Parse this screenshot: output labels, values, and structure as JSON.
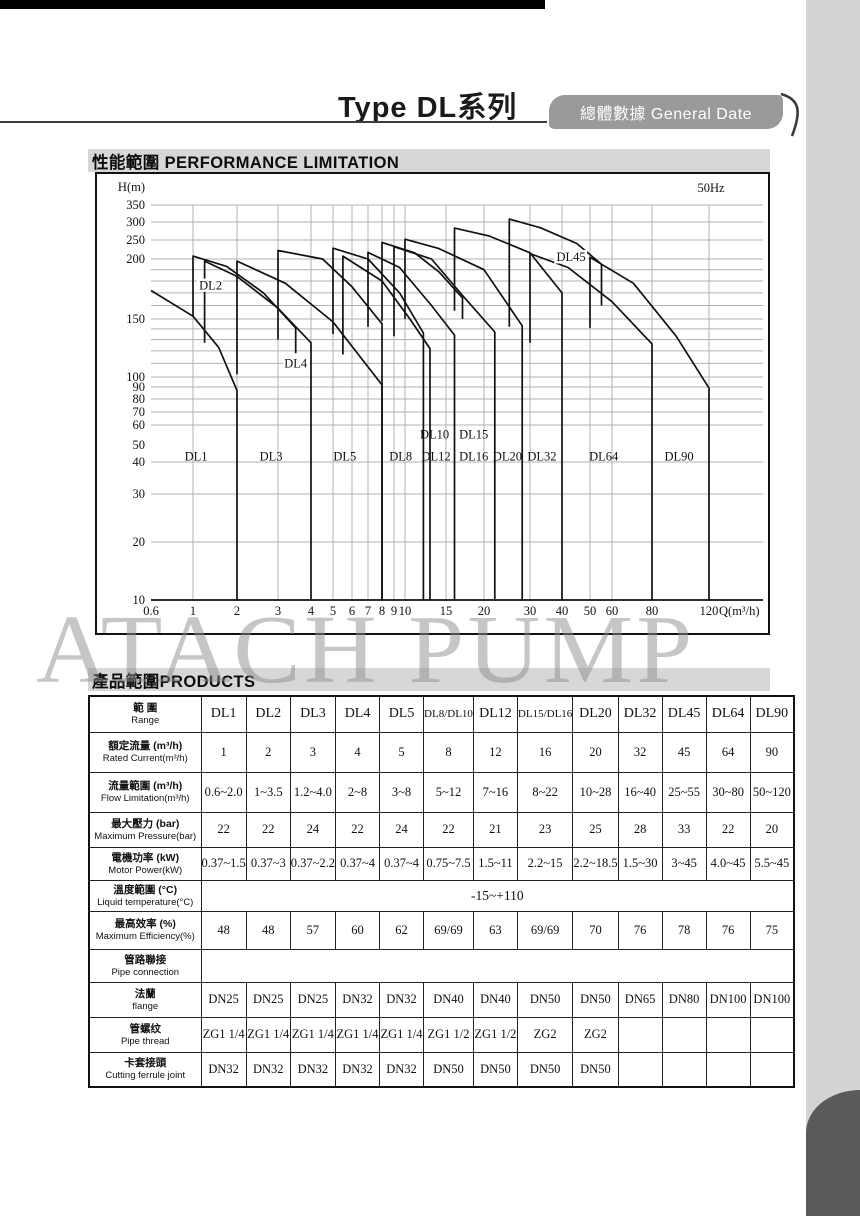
{
  "page": {
    "title": "Type DL系列",
    "badge": "總體數據 General Date"
  },
  "sections": {
    "performance": {
      "zh": "性能範圍",
      "en": "PERFORMANCE LIMITATION"
    },
    "products": {
      "zh": "產品範圍",
      "en": "PRODUCTS"
    }
  },
  "watermark": "ATACH PUMP",
  "chart_data": {
    "type": "line",
    "title": "性能範圍 PERFORMANCE LIMITATION",
    "freq_label": "50Hz",
    "xlabel": "Q(m³/h)",
    "ylabel": "H(m)",
    "x_log": true,
    "y_log": true,
    "grid": true,
    "x_ticks": [
      {
        "v": 0.6,
        "px": 54
      },
      {
        "v": 1,
        "px": 96
      },
      {
        "v": 2,
        "px": 140
      },
      {
        "v": 3,
        "px": 181
      },
      {
        "v": 4,
        "px": 214
      },
      {
        "v": 5,
        "px": 236
      },
      {
        "v": 6,
        "px": 255
      },
      {
        "v": 7,
        "px": 271
      },
      {
        "v": 8,
        "px": 285
      },
      {
        "v": 9,
        "px": 297
      },
      {
        "v": 10,
        "px": 308
      },
      {
        "v": 15,
        "px": 349
      },
      {
        "v": 20,
        "px": 387
      },
      {
        "v": 30,
        "px": 433
      },
      {
        "v": 40,
        "px": 465
      },
      {
        "v": 50,
        "px": 493
      },
      {
        "v": 60,
        "px": 515
      },
      {
        "v": 80,
        "px": 555
      },
      {
        "v": 120,
        "px": 612
      }
    ],
    "y_ticks": [
      {
        "v": 10,
        "px": 426
      },
      {
        "v": 20,
        "px": 368
      },
      {
        "v": 30,
        "px": 320
      },
      {
        "v": 40,
        "px": 288
      },
      {
        "v": 50,
        "px": 271
      },
      {
        "v": 60,
        "px": 251
      },
      {
        "v": 70,
        "px": 238
      },
      {
        "v": 80,
        "px": 225
      },
      {
        "v": 90,
        "px": 213
      },
      {
        "v": 100,
        "px": 203
      },
      {
        "v": 150,
        "px": 145
      },
      {
        "v": 200,
        "px": 85
      },
      {
        "v": 250,
        "px": 66
      },
      {
        "v": 300,
        "px": 48
      },
      {
        "v": 350,
        "px": 31
      }
    ],
    "y_ticks_no_gridline": [
      50
    ],
    "y_minor_gridlines": [
      110,
      120,
      130,
      140,
      160,
      170,
      180,
      190
    ],
    "series": [
      {
        "name": "DL1",
        "points": [
          [
            0.6,
            172
          ],
          [
            1,
            152
          ],
          [
            1.5,
            123
          ],
          [
            2,
            87
          ]
        ],
        "drop_to": 10
      },
      {
        "name": "DL2",
        "points": [
          [
            1,
            152
          ],
          [
            1,
            207
          ],
          [
            1.7,
            193
          ],
          [
            2.6,
            170
          ],
          [
            3.5,
            141
          ]
        ],
        "drop_to": 118
      },
      {
        "name": "DL3",
        "points": [
          [
            1.2,
            127
          ],
          [
            1.2,
            198
          ],
          [
            2,
            184
          ],
          [
            3,
            158
          ],
          [
            4,
            127
          ]
        ],
        "drop_to": 10
      },
      {
        "name": "DL4",
        "points": [
          [
            2,
            102
          ],
          [
            2,
            198
          ],
          [
            3.2,
            178
          ],
          [
            5,
            147
          ],
          [
            8,
            92
          ]
        ],
        "drop_to": 10
      },
      {
        "name": "DL5",
        "points": [
          [
            3,
            130
          ],
          [
            3,
            221
          ],
          [
            4.5,
            200
          ],
          [
            6,
            175
          ],
          [
            8,
            145
          ]
        ],
        "drop_to": 10
      },
      {
        "name": "DL8",
        "points": [
          [
            5,
            135
          ],
          [
            5,
            227
          ],
          [
            7,
            200
          ],
          [
            9.5,
            170
          ],
          [
            12,
            136
          ]
        ],
        "drop_to": 10
      },
      {
        "name": "DL10",
        "points": [
          [
            5.5,
            117
          ],
          [
            5.5,
            207
          ],
          [
            8,
            180
          ],
          [
            10.5,
            150
          ],
          [
            12.8,
            122
          ]
        ],
        "drop_to": 10
      },
      {
        "name": "DL12",
        "points": [
          [
            7,
            142
          ],
          [
            7,
            216
          ],
          [
            9.5,
            192
          ],
          [
            13,
            160
          ],
          [
            16,
            134
          ]
        ],
        "drop_to": 10
      },
      {
        "name": "DL15",
        "points": [
          [
            8,
            148
          ],
          [
            8,
            243
          ],
          [
            11,
            215
          ],
          [
            14,
            188
          ],
          [
            17,
            166
          ]
        ],
        "drop_to": 150
      },
      {
        "name": "DL16",
        "points": [
          [
            9,
            133
          ],
          [
            9,
            231
          ],
          [
            13,
            200
          ],
          [
            17,
            168
          ],
          [
            22,
            137
          ]
        ],
        "drop_to": 10
      },
      {
        "name": "DL20",
        "points": [
          [
            10,
            150
          ],
          [
            10,
            252
          ],
          [
            14,
            226
          ],
          [
            20,
            190
          ],
          [
            28,
            143
          ]
        ],
        "drop_to": 10
      },
      {
        "name": "DL32",
        "points": [
          [
            16,
            156
          ],
          [
            16,
            282
          ],
          [
            21,
            260
          ],
          [
            30,
            215
          ],
          [
            40,
            170
          ]
        ],
        "drop_to": 10
      },
      {
        "name": "DL45",
        "points": [
          [
            25,
            142
          ],
          [
            25,
            308
          ],
          [
            33,
            283
          ],
          [
            45,
            240
          ],
          [
            55,
            195
          ]
        ],
        "drop_to": 160
      },
      {
        "name": "DL64",
        "points": [
          [
            30,
            127
          ],
          [
            30,
            213
          ],
          [
            42,
            192
          ],
          [
            60,
            163
          ],
          [
            80,
            126
          ]
        ],
        "drop_to": 10
      },
      {
        "name": "DL90",
        "points": [
          [
            50,
            141
          ],
          [
            50,
            204
          ],
          [
            70,
            178
          ],
          [
            95,
            133
          ],
          [
            120,
            89
          ]
        ],
        "drop_to": 10
      }
    ],
    "labels": [
      {
        "text": "DL1",
        "q": 1.05,
        "h": 43
      },
      {
        "text": "DL3",
        "q": 2.8,
        "h": 43
      },
      {
        "text": "DL5",
        "q": 5.6,
        "h": 43
      },
      {
        "text": "DL8",
        "q": 9.6,
        "h": 43
      },
      {
        "text": "DL10",
        "q": 13.4,
        "h": 55
      },
      {
        "text": "DL12",
        "q": 13.6,
        "h": 43
      },
      {
        "text": "DL15",
        "q": 18.5,
        "h": 55
      },
      {
        "text": "DL16",
        "q": 18.5,
        "h": 43
      },
      {
        "text": "DL20",
        "q": 24.6,
        "h": 43
      },
      {
        "text": "DL32",
        "q": 33.4,
        "h": 43
      },
      {
        "text": "DL64",
        "q": 56,
        "h": 43
      },
      {
        "text": "DL90",
        "q": 97,
        "h": 43
      },
      {
        "text": "DL2",
        "q": 1.32,
        "h": 176,
        "halo": true
      },
      {
        "text": "DL4",
        "q": 3.5,
        "h": 110,
        "halo": true
      },
      {
        "text": "DL45",
        "q": 43,
        "h": 205,
        "halo": true
      }
    ]
  },
  "table": {
    "corner": {
      "zh": "範 圍",
      "en": "Range"
    },
    "columns": [
      "DL1",
      "DL2",
      "DL3",
      "DL4",
      "DL5",
      "DL8/DL10",
      "DL12",
      "DL15/DL16",
      "DL20",
      "DL32",
      "DL45",
      "DL64",
      "DL90"
    ],
    "rows": [
      {
        "zh": "額定流量 (m³/h)",
        "en": "Rated Current(m³/h)",
        "values": [
          "1",
          "2",
          "3",
          "4",
          "5",
          "8",
          "12",
          "16",
          "20",
          "32",
          "45",
          "64",
          "90"
        ]
      },
      {
        "zh": "流量範圍 (m³/h)",
        "en": "Flow Limitation(m³/h)",
        "values": [
          "0.6~2.0",
          "1~3.5",
          "1.2~4.0",
          "2~8",
          "3~8",
          "5~12",
          "7~16",
          "8~22",
          "10~28",
          "16~40",
          "25~55",
          "30~80",
          "50~120"
        ]
      },
      {
        "zh": "最大壓力 (bar)",
        "en": "Maximum Pressure(bar)",
        "values": [
          "22",
          "22",
          "24",
          "22",
          "24",
          "22",
          "21",
          "23",
          "25",
          "28",
          "33",
          "22",
          "20"
        ]
      },
      {
        "zh": "電機功率 (kW)",
        "en": "Motor Power(kW)",
        "values": [
          "0.37~1.5",
          "0.37~3",
          "0.37~2.2",
          "0.37~4",
          "0.37~4",
          "0.75~7.5",
          "1.5~11",
          "2.2~15",
          "2.2~18.5",
          "1.5~30",
          "3~45",
          "4.0~45",
          "5.5~45"
        ]
      },
      {
        "zh": "溫度範圍 (°C)",
        "en": "Liquid temperature(°C)",
        "span": "-15~+110"
      },
      {
        "zh": "最高效率 (%)",
        "en": "Maximum Efficiency(%)",
        "values": [
          "48",
          "48",
          "57",
          "60",
          "62",
          "69/69",
          "63",
          "69/69",
          "70",
          "76",
          "78",
          "76",
          "75"
        ]
      },
      {
        "zh": "管路聯接",
        "en": "Pipe connection",
        "span": ""
      },
      {
        "zh": "法蘭",
        "en": "flange",
        "values": [
          "DN25",
          "DN25",
          "DN25",
          "DN32",
          "DN32",
          "DN40",
          "DN40",
          "DN50",
          "DN50",
          "DN65",
          "DN80",
          "DN100",
          "DN100"
        ]
      },
      {
        "zh": "管螺纹",
        "en": "Pipe thread",
        "values": [
          "ZG1 1/4",
          "ZG1 1/4",
          "ZG1 1/4",
          "ZG1 1/4",
          "ZG1 1/4",
          "ZG1 1/2",
          "ZG1 1/2",
          "ZG2",
          "ZG2",
          "",
          "",
          "",
          ""
        ]
      },
      {
        "zh": "卡套接頭",
        "en": "Cutting ferrule joint",
        "values": [
          "DN32",
          "DN32",
          "DN32",
          "DN32",
          "DN32",
          "DN50",
          "DN50",
          "DN50",
          "DN50",
          "",
          "",
          "",
          ""
        ]
      }
    ]
  },
  "colors": {
    "bar_gray": "#d7d7d7",
    "badge_gray": "#9a9a9a",
    "band_gray": "#d3d3d3",
    "corner_gray": "#5a5a5a",
    "grid_gray": "#b3b3b3",
    "ink": "#111111"
  }
}
